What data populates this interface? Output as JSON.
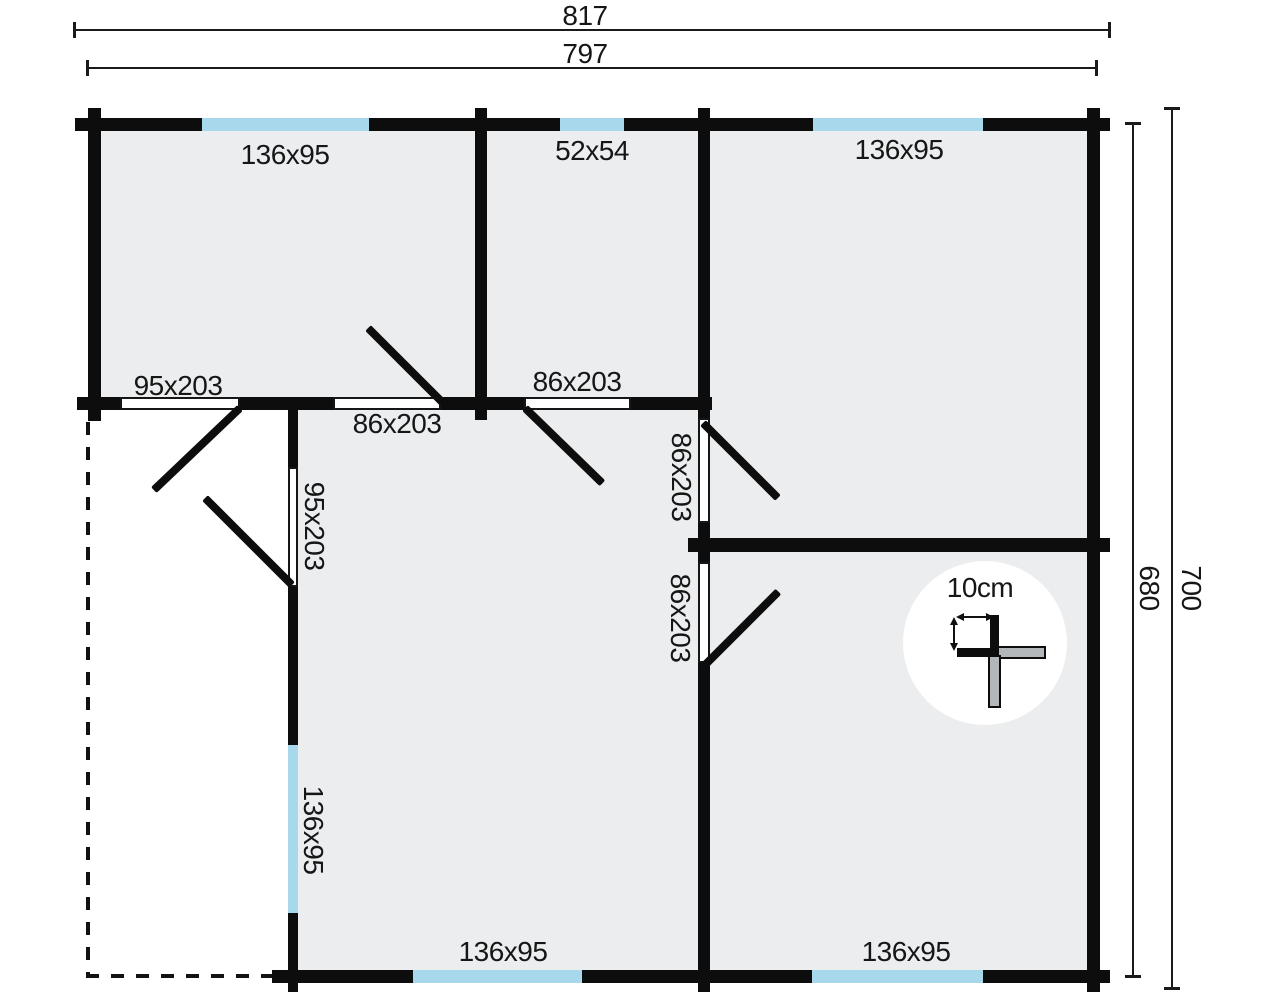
{
  "plan_type": "floor-plan",
  "colors": {
    "wall": "#0d0d0d",
    "room_fill": "#ebedee",
    "window": "#a7d8eb",
    "paper": "#ffffff",
    "dimension_line": "#1a1a1a",
    "scale_gray": "#b4b7b9"
  },
  "dimensions": {
    "top_overall": "817",
    "top_wall": "797",
    "right_wall": "680",
    "right_overall": "700"
  },
  "windows": {
    "top_left": "136x95",
    "top_middle": "52x54",
    "top_right": "136x95",
    "left_wall": "136x95",
    "bottom_left": "136x95",
    "bottom_right": "136x95"
  },
  "doors": {
    "terrace": "95x203",
    "hall": "95x203",
    "room_left": "86x203",
    "living": "86x203",
    "right_top": "86x203",
    "right_bottom": "86x203"
  },
  "scale_indicator": {
    "label": "10cm"
  }
}
